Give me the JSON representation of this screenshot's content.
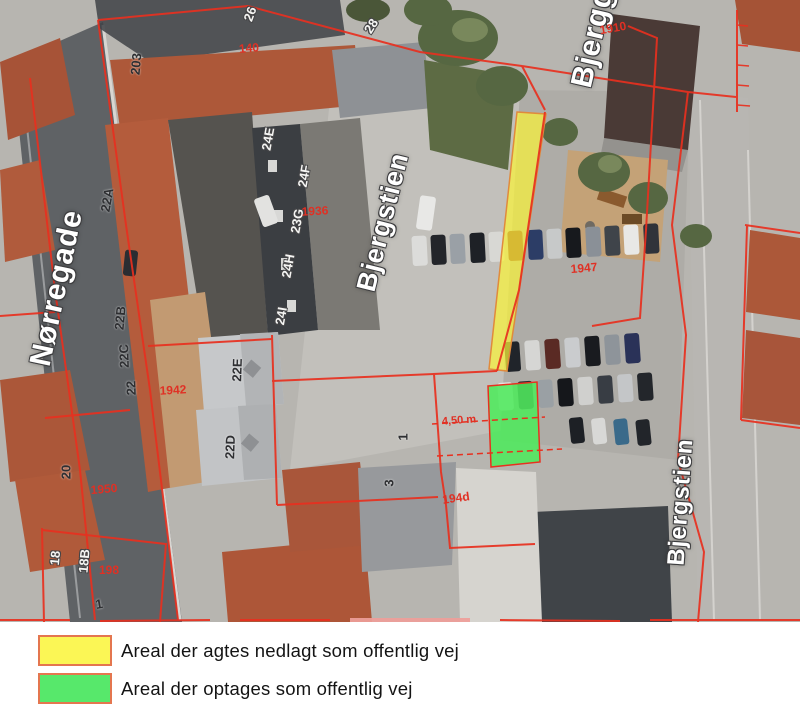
{
  "map": {
    "street_labels": [
      {
        "text": "Nørregade"
      },
      {
        "text": "Bjergstien"
      },
      {
        "text": "Bjergg"
      },
      {
        "text": "Bjergstien"
      }
    ],
    "parcel_labels": [
      {
        "text": "22A"
      },
      {
        "text": "22B"
      },
      {
        "text": "22C"
      },
      {
        "text": "22"
      },
      {
        "text": "22E"
      },
      {
        "text": "22D"
      },
      {
        "text": "20"
      },
      {
        "text": "1"
      },
      {
        "text": "1"
      },
      {
        "text": "3"
      },
      {
        "text": "203"
      },
      {
        "text": "24E"
      },
      {
        "text": "24F"
      },
      {
        "text": "23G"
      },
      {
        "text": "24H"
      },
      {
        "text": "24I"
      },
      {
        "text": "28"
      },
      {
        "text": "26"
      },
      {
        "text": "18"
      },
      {
        "text": "18B"
      }
    ],
    "matrikel_labels": [
      {
        "text": "1910"
      },
      {
        "text": "140"
      },
      {
        "text": "1936"
      },
      {
        "text": "1947"
      },
      {
        "text": "1942"
      },
      {
        "text": "194d"
      },
      {
        "text": "1950"
      },
      {
        "text": "198"
      }
    ],
    "measurement_label": {
      "text": "4,50 m"
    },
    "colors": {
      "highlight_yellow": "#faf23a",
      "highlight_green": "#4ee95c",
      "cadastral_line": "#e8301f",
      "street_label_text": "#ffffff",
      "matrikel_text": "#e03024"
    }
  },
  "legend": {
    "items": [
      {
        "label": "Areal der agtes nedlagt som offentlig vej",
        "swatch_color": "#fbf655",
        "swatch_border": "#e4764f"
      },
      {
        "label": "Areal der optages som offentlig vej",
        "swatch_color": "#57e86b",
        "swatch_border": "#e4764f"
      }
    ]
  }
}
